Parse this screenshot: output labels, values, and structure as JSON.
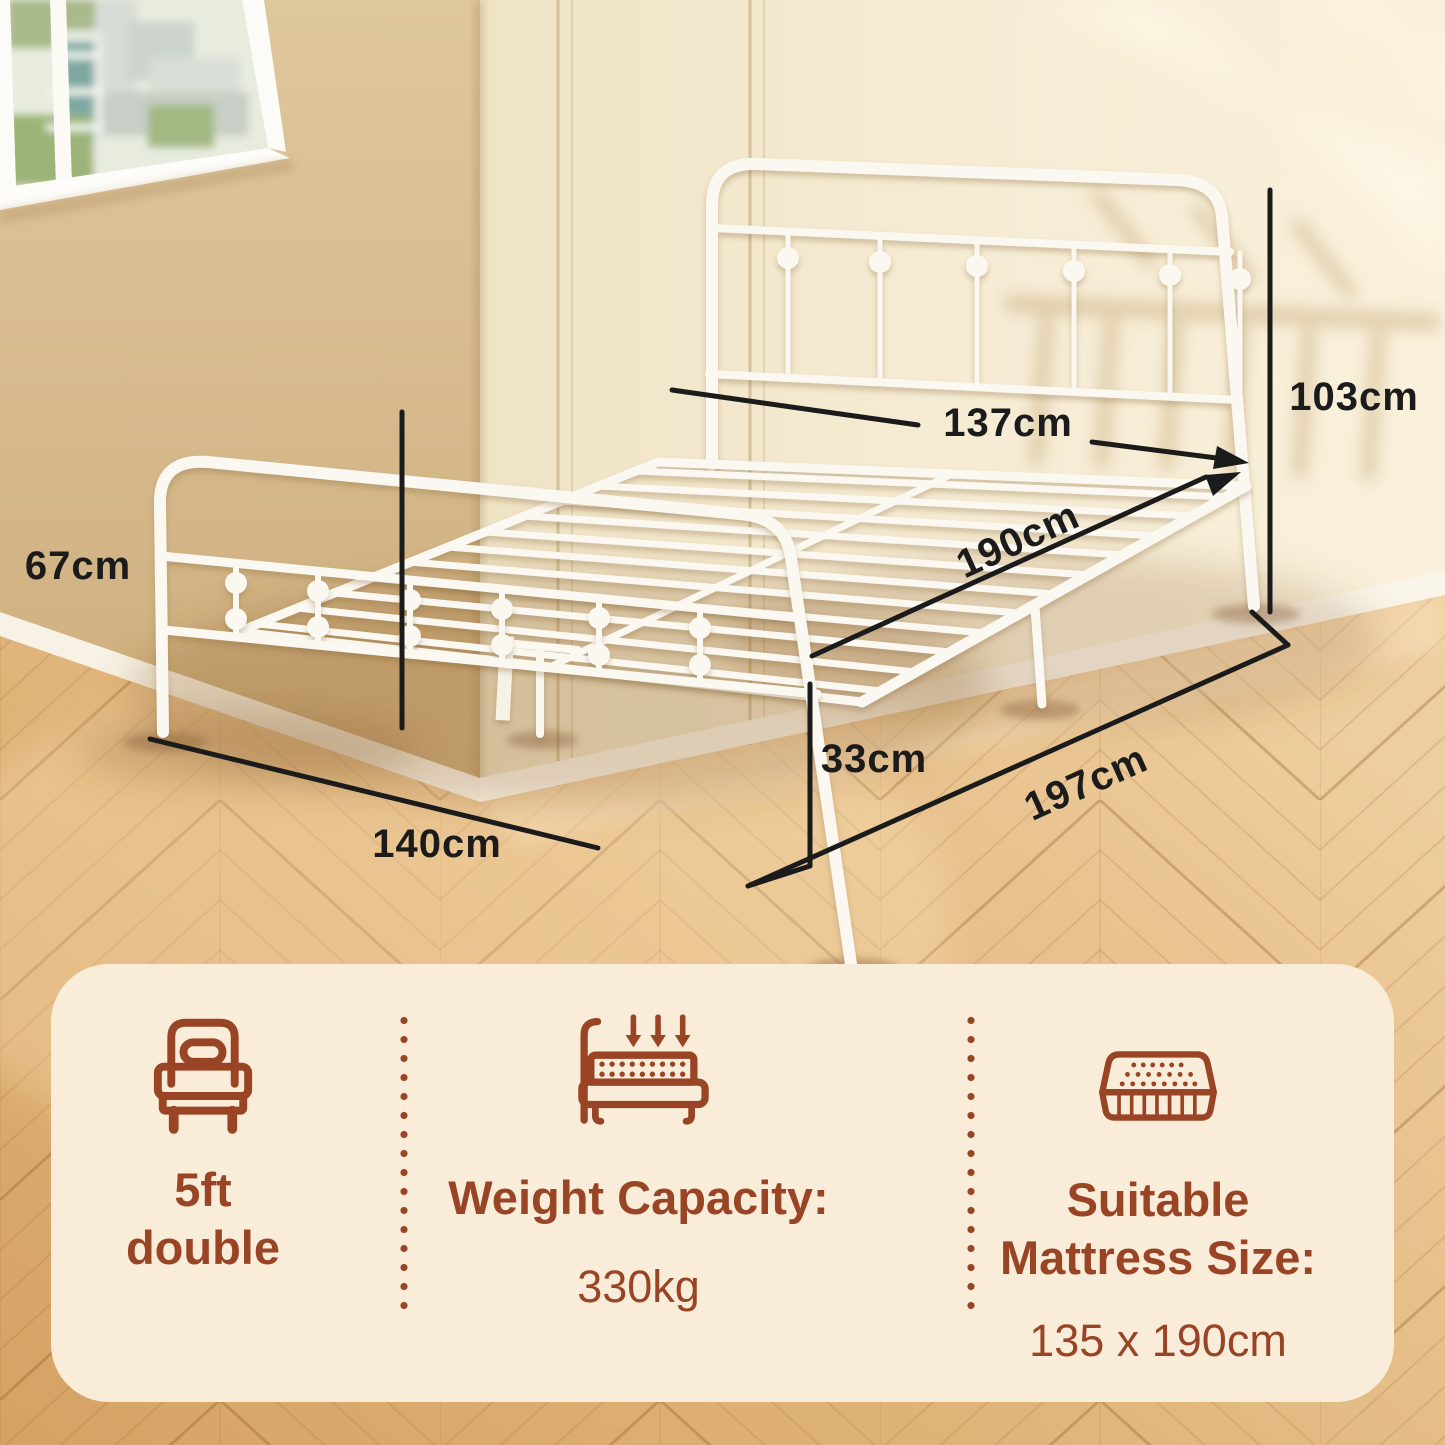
{
  "colors": {
    "accent_brown": "#9a4426",
    "panel_bg": "#f9edda",
    "dimension_text": "#1b1b1b",
    "wall_left_tan": "#d9bf92",
    "wall_right_cream": "#f4ead2",
    "floor_wood": "#ddae74",
    "bed_frame_white": "#fbf8f1"
  },
  "dimensions": [
    {
      "id": "headboard-width",
      "value": "137cm"
    },
    {
      "id": "headboard-height",
      "value": "103cm"
    },
    {
      "id": "bed-length",
      "value": "190cm"
    },
    {
      "id": "footboard-height",
      "value": "67cm"
    },
    {
      "id": "base-height",
      "value": "33cm"
    },
    {
      "id": "overall-length",
      "value": "197cm"
    },
    {
      "id": "overall-width",
      "value": "140cm"
    }
  ],
  "info_panel": {
    "columns": [
      {
        "icon": "single-bed-icon",
        "line1": "5ft",
        "line2": "double"
      },
      {
        "icon": "weight-capacity-icon",
        "title": "Weight Capacity:",
        "value": "330kg"
      },
      {
        "icon": "mattress-icon",
        "title_line1": "Suitable",
        "title_line2": "Mattress Size:",
        "value": "135 x 190cm"
      }
    ]
  }
}
